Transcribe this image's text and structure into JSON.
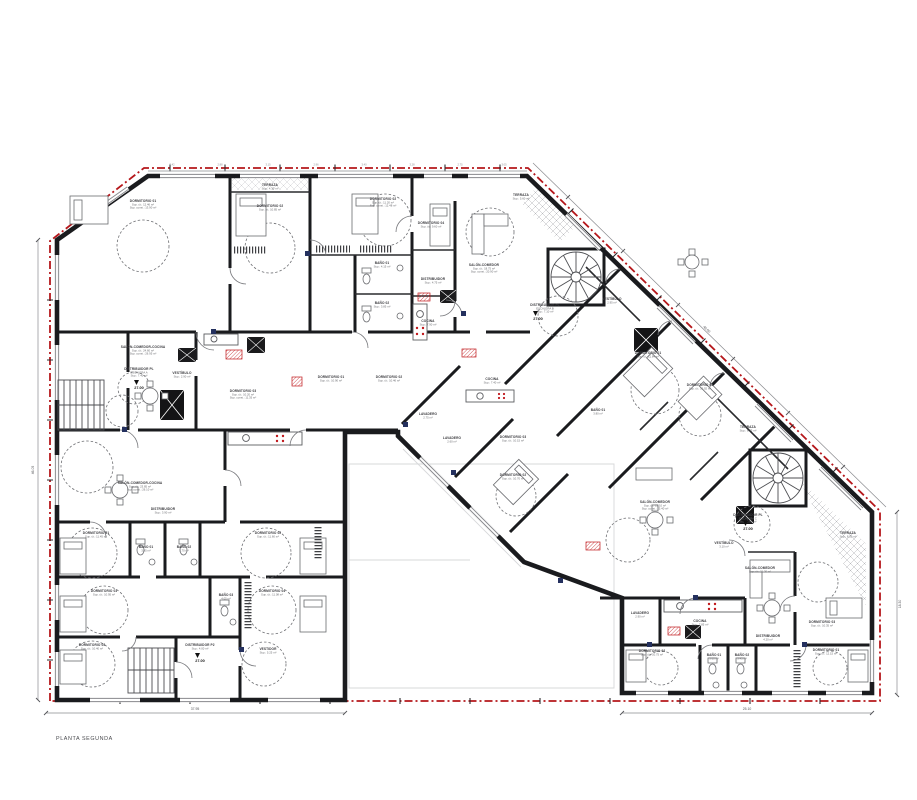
{
  "title_block": {
    "plan_title": "PLANTA SEGUNDA"
  },
  "colors": {
    "boundary": "#b5171b",
    "wall": "#1a1b1e",
    "shaft_red": "#c0181c",
    "hinge_navy": "#24305e"
  },
  "levels": [
    {
      "value": "27.00",
      "x": 139,
      "y": 389
    },
    {
      "value": "27.00",
      "x": 538,
      "y": 320
    },
    {
      "value": "27.00",
      "x": 748,
      "y": 530
    },
    {
      "value": "27.00",
      "x": 200,
      "y": 662
    }
  ],
  "dims": {
    "bottom_left": "37.95",
    "bottom_right": "25.10",
    "left": "46.05",
    "right": "18.30",
    "diagonal": "48.60"
  },
  "tick_xs": [
    172,
    220,
    268,
    316,
    364,
    412,
    460,
    504
  ],
  "tick_labels": [
    "3.42",
    "2.88",
    "3.15",
    "2.96",
    "3.40",
    "3.28",
    "2.75",
    "3.05"
  ],
  "rooms": [
    {
      "label": "DORMITORIO 01",
      "lines": [
        "Sup. út.: 12.46 m²",
        "Sup. const.: 13.90 m²"
      ],
      "x": 143,
      "y": 202
    },
    {
      "label": "TERRAZA",
      "lines": [
        "Sup.: 4.30 m²"
      ],
      "x": 270,
      "y": 186
    },
    {
      "label": "DORMITORIO 02",
      "lines": [
        "Sup. út.: 10.85 m²"
      ],
      "x": 270,
      "y": 207
    },
    {
      "label": "DORMITORIO 02",
      "lines": [
        "Sup. út.: 11.20 m²",
        "Sup. const.: 12.48 m²"
      ],
      "x": 383,
      "y": 200
    },
    {
      "label": "DORMITORIO 04",
      "lines": [
        "Sup. út.: 9.60 m²"
      ],
      "x": 431,
      "y": 224
    },
    {
      "label": "SALÓN-COMEDOR",
      "lines": [
        "Sup. út.: 18.75 m²",
        "Sup. const.: 20.90 m²"
      ],
      "x": 484,
      "y": 266
    },
    {
      "label": "TERRAZA",
      "lines": [
        "Sup.: 5.60 m²"
      ],
      "x": 521,
      "y": 196
    },
    {
      "label": "BAÑO 01",
      "lines": [
        "Sup.: 4.15 m²"
      ],
      "x": 382,
      "y": 264
    },
    {
      "label": "BAÑO 02",
      "lines": [
        "Sup.: 3.85 m²"
      ],
      "x": 382,
      "y": 304
    },
    {
      "label": "DISTRIBUIDOR",
      "lines": [
        "Sup.: 4.75 m²"
      ],
      "x": 433,
      "y": 280
    },
    {
      "label": "COCINA",
      "lines": [
        "Sup.: 7.90 m²"
      ],
      "x": 428,
      "y": 322
    },
    {
      "label": "SALÓN-COMEDOR-COCINA",
      "lines": [
        "Sup. út.: 24.60 m²",
        "Sup. const.: 26.95 m²"
      ],
      "x": 143,
      "y": 348
    },
    {
      "label": "DISTRIBUIDOR PL",
      "lines": [
        "ESCALERA A",
        "Sup.: 7.40 m²"
      ],
      "x": 139,
      "y": 370
    },
    {
      "label": "VESTÍBULO",
      "lines": [
        "Sup.: 2.90 m²"
      ],
      "x": 182,
      "y": 374
    },
    {
      "label": "DORMITORIO 03",
      "lines": [
        "Sup. út.: 10.20 m²",
        "Sup. const.: 11.35 m²"
      ],
      "x": 243,
      "y": 392
    },
    {
      "label": "DORMITORIO 01",
      "lines": [
        "Sup. út.: 10.90 m²"
      ],
      "x": 331,
      "y": 378
    },
    {
      "label": "DORMITORIO 02",
      "lines": [
        "Sup. út.: 10.46 m²"
      ],
      "x": 389,
      "y": 378
    },
    {
      "label": "SALÓN-COMEDOR-COCINA",
      "lines": [
        "Sup. út.: 23.85 m²",
        "Sup. const.: 26.10 m²"
      ],
      "x": 140,
      "y": 484
    },
    {
      "label": "DISTRIBUIDOR",
      "lines": [
        "Sup.: 3.90 m²"
      ],
      "x": 163,
      "y": 510
    },
    {
      "label": "DORMITORIO 01",
      "lines": [
        "Sup. út.: 11.45 m²"
      ],
      "x": 96,
      "y": 534
    },
    {
      "label": "DORMITORIO 02",
      "lines": [
        "Sup. út.: 11.60 m²"
      ],
      "x": 268,
      "y": 534
    },
    {
      "label": "BAÑO 01",
      "lines": [
        "3.95 m²"
      ],
      "x": 146,
      "y": 548
    },
    {
      "label": "BAÑO 02",
      "lines": [
        "3.70 m²"
      ],
      "x": 184,
      "y": 548
    },
    {
      "label": "DORMITORIO 03",
      "lines": [
        "Sup. út.: 10.95 m²"
      ],
      "x": 104,
      "y": 592
    },
    {
      "label": "DORMITORIO 04",
      "lines": [
        "Sup. út.: 11.08 m²"
      ],
      "x": 272,
      "y": 592
    },
    {
      "label": "BAÑO 03",
      "lines": [
        "4.05 m²"
      ],
      "x": 226,
      "y": 596
    },
    {
      "label": "DORMITORIO 05",
      "lines": [
        "Sup. út.: 10.40 m²"
      ],
      "x": 92,
      "y": 646
    },
    {
      "label": "VESTIDOR",
      "lines": [
        "Sup.: 5.25 m²"
      ],
      "x": 268,
      "y": 650
    },
    {
      "label": "DISTRIBUIDOR P2",
      "lines": [
        "Sup.: 4.00 m²"
      ],
      "x": 200,
      "y": 646
    },
    {
      "label": "DISTRIBUIDOR PL",
      "lines": [
        "ESCALERA B",
        "Sup.: 7.10 m²"
      ],
      "x": 545,
      "y": 306
    },
    {
      "label": "VESTÍBULO",
      "lines": [
        "2.95 m²"
      ],
      "x": 612,
      "y": 300
    },
    {
      "label": "DORMITORIO 01",
      "lines": [
        "Sup. út.: 11.84 m²"
      ],
      "x": 648,
      "y": 354
    },
    {
      "label": "DORMITORIO 02",
      "lines": [
        "Sup. út.: 10.92 m²"
      ],
      "x": 700,
      "y": 386
    },
    {
      "label": "TERRAZA",
      "lines": [
        "Sup.: 6.75 m²"
      ],
      "x": 748,
      "y": 428
    },
    {
      "label": "COCINA",
      "lines": [
        "Sup.: 7.40 m²"
      ],
      "x": 492,
      "y": 380
    },
    {
      "label": "LAVADERO",
      "lines": [
        "2.75 m²"
      ],
      "x": 428,
      "y": 415
    },
    {
      "label": "LAVADERO",
      "lines": [
        "2.60 m²"
      ],
      "x": 452,
      "y": 439
    },
    {
      "label": "DORMITORIO 03",
      "lines": [
        "Sup. út.: 10.15 m²"
      ],
      "x": 513,
      "y": 438
    },
    {
      "label": "DORMITORIO 02",
      "lines": [
        "Sup. út.: 10.70 m²"
      ],
      "x": 513,
      "y": 476
    },
    {
      "label": "SALÓN-COMEDOR",
      "lines": [
        "Sup. út.: 23.10 m²",
        "Sup. const.: 25.40 m²"
      ],
      "x": 655,
      "y": 503
    },
    {
      "label": "DISTRIBUIDOR PL",
      "lines": [
        "ESCALERA C",
        "Sup.: 6.80 m²"
      ],
      "x": 748,
      "y": 516
    },
    {
      "label": "VESTÍBULO",
      "lines": [
        "3.10 m²"
      ],
      "x": 724,
      "y": 544
    },
    {
      "label": "BAÑO 01",
      "lines": [
        "3.80 m²"
      ],
      "x": 598,
      "y": 411
    },
    {
      "label": "SALÓN-COMEDOR",
      "lines": [
        "Sup. út.: 21.30 m²"
      ],
      "x": 760,
      "y": 569
    },
    {
      "label": "DORMITORIO 03",
      "lines": [
        "Sup. út.: 10.35 m²"
      ],
      "x": 822,
      "y": 623
    },
    {
      "label": "TERRAZA",
      "lines": [
        "Sup.: 8.20 m²"
      ],
      "x": 848,
      "y": 534
    },
    {
      "label": "LAVADERO",
      "lines": [
        "2.90 m²"
      ],
      "x": 640,
      "y": 614
    },
    {
      "label": "COCINA",
      "lines": [
        "Sup.: 7.85 m²"
      ],
      "x": 700,
      "y": 622
    },
    {
      "label": "DISTRIBUIDOR",
      "lines": [
        "4.20 m²"
      ],
      "x": 768,
      "y": 637
    },
    {
      "label": "DORMITORIO 02",
      "lines": [
        "Sup. út.: 10.75 m²"
      ],
      "x": 652,
      "y": 652
    },
    {
      "label": "BAÑO 01",
      "lines": [
        "3.60 m²"
      ],
      "x": 714,
      "y": 656
    },
    {
      "label": "BAÑO 02",
      "lines": [
        "3.45 m²"
      ],
      "x": 742,
      "y": 656
    },
    {
      "label": "DORMITORIO 01",
      "lines": [
        "Sup. út.: 12.15 m²"
      ],
      "x": 826,
      "y": 651
    }
  ]
}
